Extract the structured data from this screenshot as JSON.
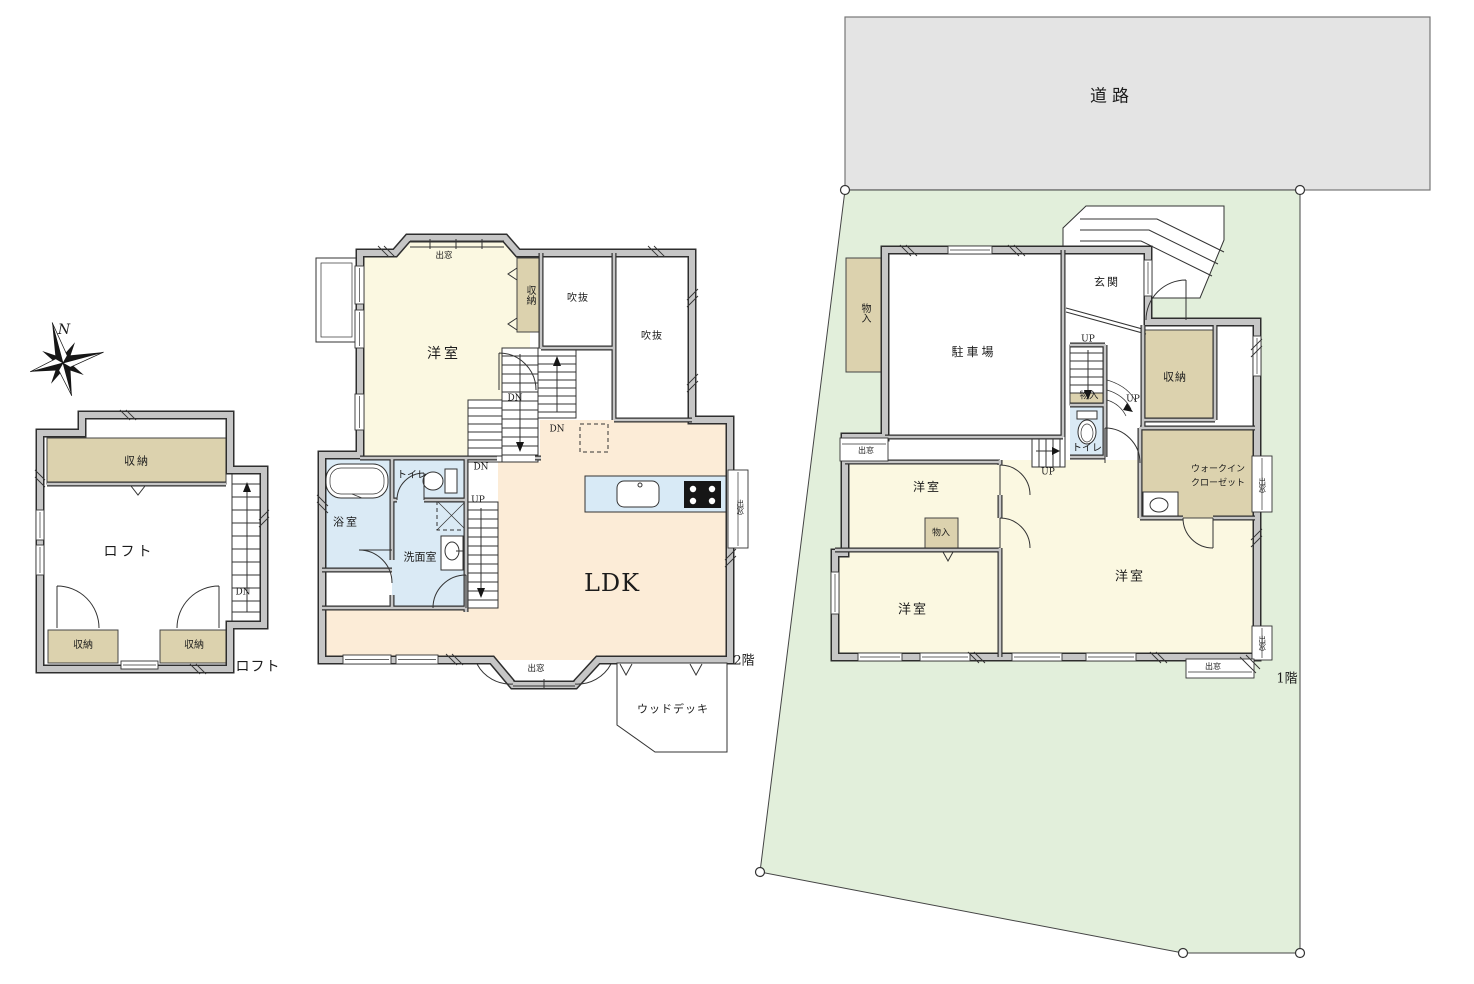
{
  "colors": {
    "wall": "#c6c6c6",
    "cream": "#fbf8e1",
    "peach": "#fcecd7",
    "blue": "#daeaf5",
    "beige": "#dcd2ae",
    "lot": "#e2efdb",
    "road": "#e4e4e4",
    "counter": "#d8eaf6",
    "line": "#333333"
  },
  "compass": {
    "north": "N"
  },
  "loft": {
    "caption": "ロフト",
    "storage_top": "収納",
    "room": "ロフト",
    "storage_left": "収納",
    "storage_right": "収納",
    "dn": "DN"
  },
  "floor2": {
    "caption": "2階",
    "bay_top": "出窓",
    "yoshitsu": "洋室",
    "shuno": "収納",
    "fukinuke_a": "吹抜",
    "fukinuke_b": "吹抜",
    "dn_a": "DN",
    "dn_b": "DN",
    "dn_c": "DN",
    "up": "UP",
    "toilet": "トイレ",
    "bath": "浴室",
    "senmen": "洗面室",
    "ldk": "LDK",
    "bay_right": "出窓",
    "bay_bottom": "出窓",
    "wood_deck": "ウッドデッキ"
  },
  "floor1": {
    "caption": "1階",
    "road": "道路",
    "monoire_side": "物入",
    "parking": "駐車場",
    "genkan": "玄関",
    "up_a": "UP",
    "up_b": "UP",
    "up_c": "UP",
    "monoire_stair": "物入",
    "toilet": "トイレ",
    "shuno": "収納",
    "wic_line1": "ウォークイン",
    "wic_line2": "クローゼット",
    "bay_left": "出窓",
    "yoshitsu_a": "洋室",
    "monoire_room": "物入",
    "yoshitsu_b": "洋室",
    "yoshitsu_c": "洋室",
    "bay_right_a": "出窓",
    "bay_right_b": "出窓",
    "bay_bottom": "出窓"
  }
}
